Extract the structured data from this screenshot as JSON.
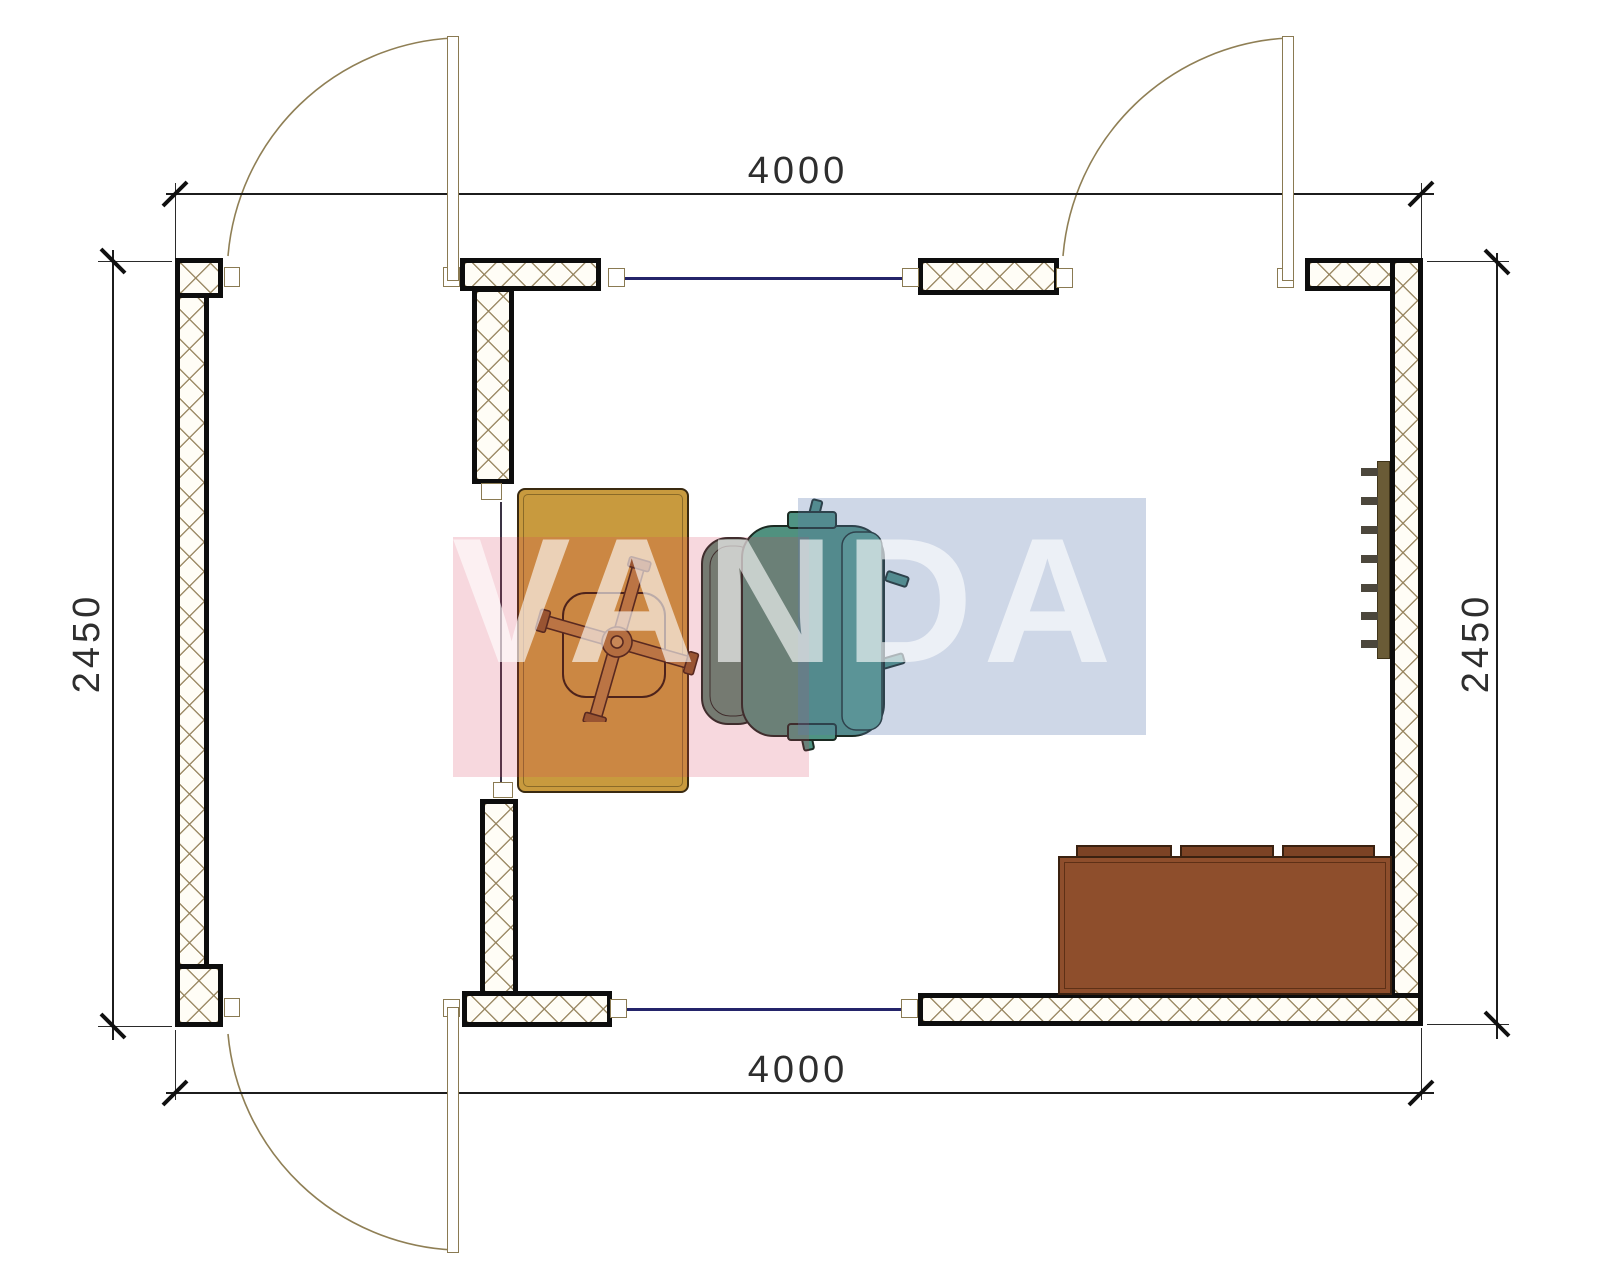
{
  "title": "apartment-room-floor-plan",
  "watermark": {
    "text": "VANDA",
    "pink_color": "#f5cdd4",
    "blue_color": "#cfd8e9",
    "letter_color": "rgba(255,255,255,0.62)"
  },
  "dimensions": {
    "top": "4000",
    "bottom": "4000",
    "left": "2450",
    "right": "2450"
  },
  "elements": {
    "doors": [
      "top-left-door",
      "top-right-door",
      "bottom-left-door"
    ],
    "windows": [
      "top-window",
      "bottom-window",
      "interior-opening"
    ],
    "furniture": [
      "desk",
      "office-chair",
      "chair-star-base",
      "sofa",
      "radiator"
    ]
  },
  "colors": {
    "wall_hatch": "#94815a",
    "wall_border": "#0d0d0d",
    "desk": "#c89a3e",
    "chair": "#50917f",
    "sofa": "#8e4e2c",
    "sofa_cushion": "#7c4325",
    "radiator": "#6a5b36",
    "window_line": "#24246a",
    "door_line": "#8f7f55",
    "dimension_text": "#2e2e2e"
  }
}
